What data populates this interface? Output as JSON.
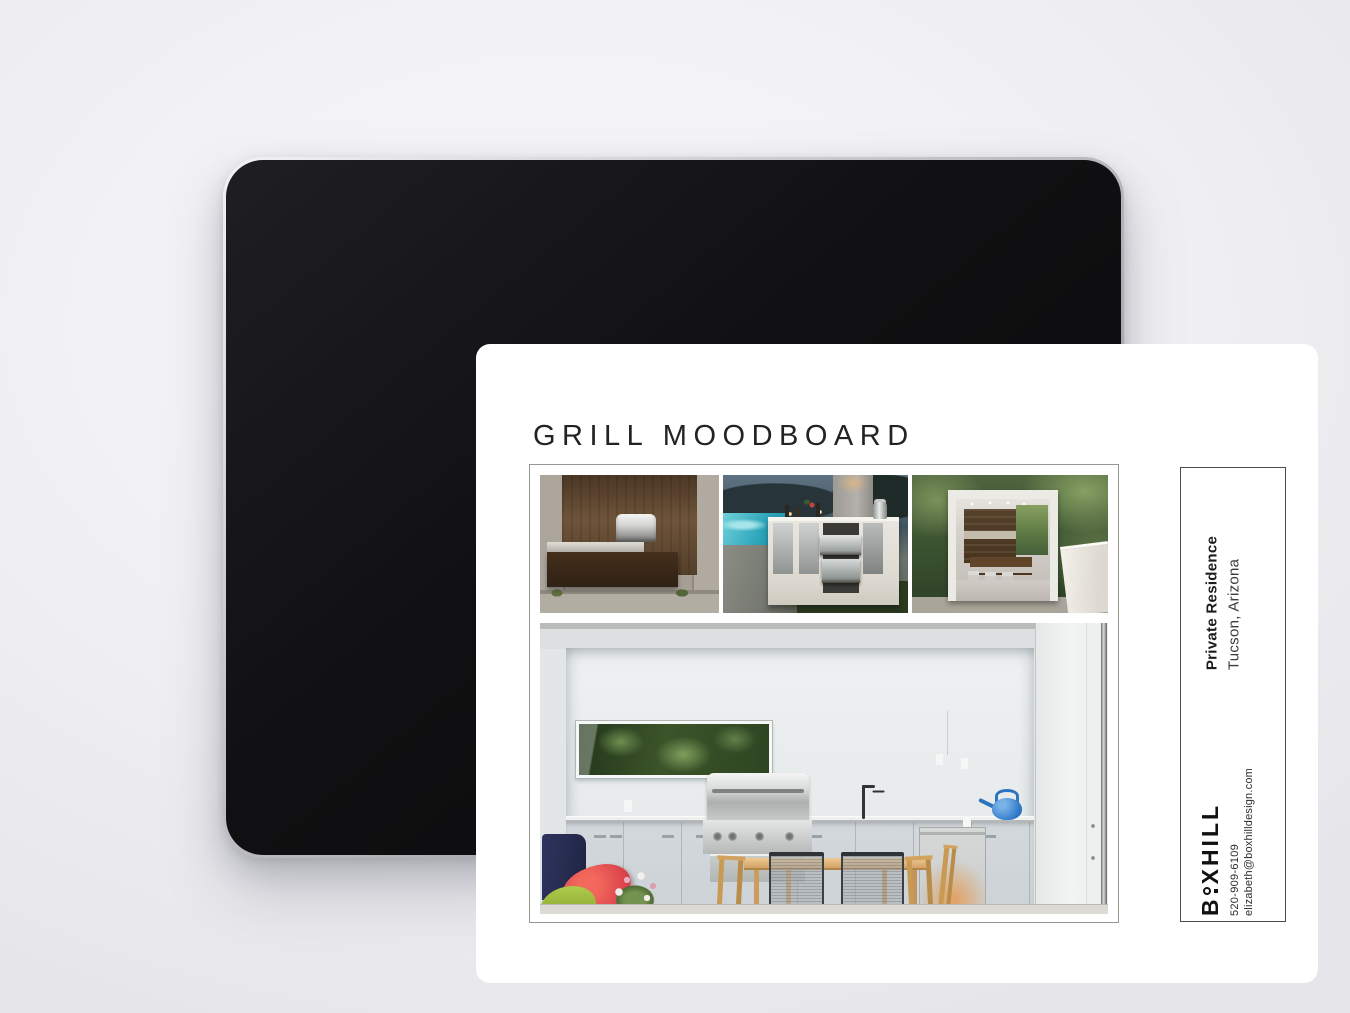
{
  "header": {
    "title": "GRILL MOODBOARD"
  },
  "moodboard": {
    "images": [
      {
        "alt": "Corten steel grill station built into a concrete wall"
      },
      {
        "alt": "White outdoor kitchen island with stainless drawers beside a pool at dusk"
      },
      {
        "alt": "Outdoor kitchen pavilion with dark wood cabinetry surrounded by forest"
      },
      {
        "alt": "White modern outdoor kitchen with built-in grill, dining set and blue watering can"
      }
    ]
  },
  "side_panel": {
    "project_name": "Private Residence",
    "project_location": "Tucson, Arizona",
    "brand_full": "BOXHILL",
    "brand_b": "B",
    "brand_rest": "XHILL",
    "phone": "520-909-6109",
    "email": "elizabeth@boxhilldesign.com"
  }
}
